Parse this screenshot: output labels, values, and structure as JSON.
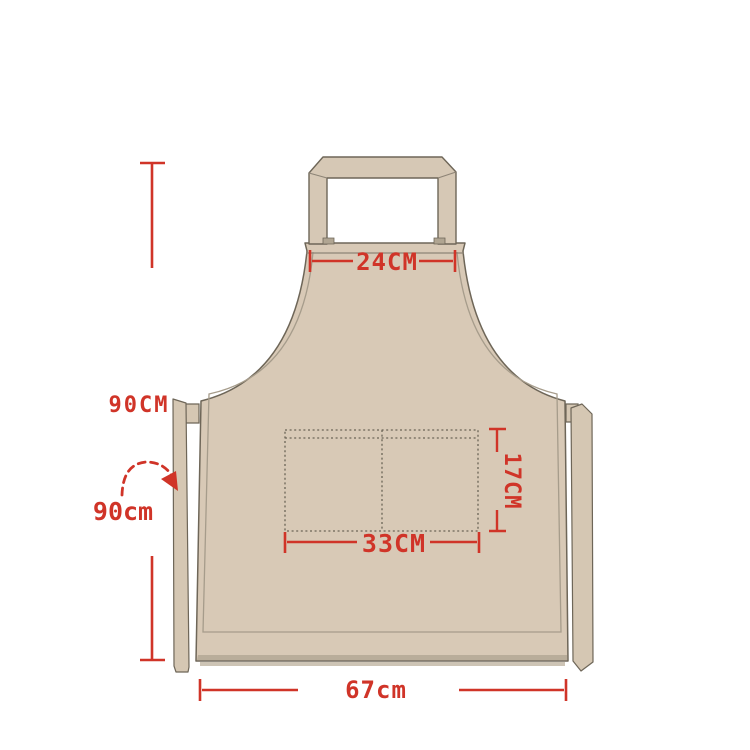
{
  "diagram": {
    "subject": "apron-size-diagram",
    "labels": {
      "neck_strap_width": "24CM",
      "body_length": "90CM",
      "waist_tie_length": "90cm",
      "pocket_height": "17CM",
      "pocket_width": "33CM",
      "bottom_width": "67cm"
    },
    "colors": {
      "fabric": "#d8c9b6",
      "fabric_dark_band": "#b9ad9a",
      "outline": "#6e6658",
      "inner_seam": "#a69c8b",
      "dimension_red": "#d03428",
      "background": "#ffffff"
    }
  }
}
